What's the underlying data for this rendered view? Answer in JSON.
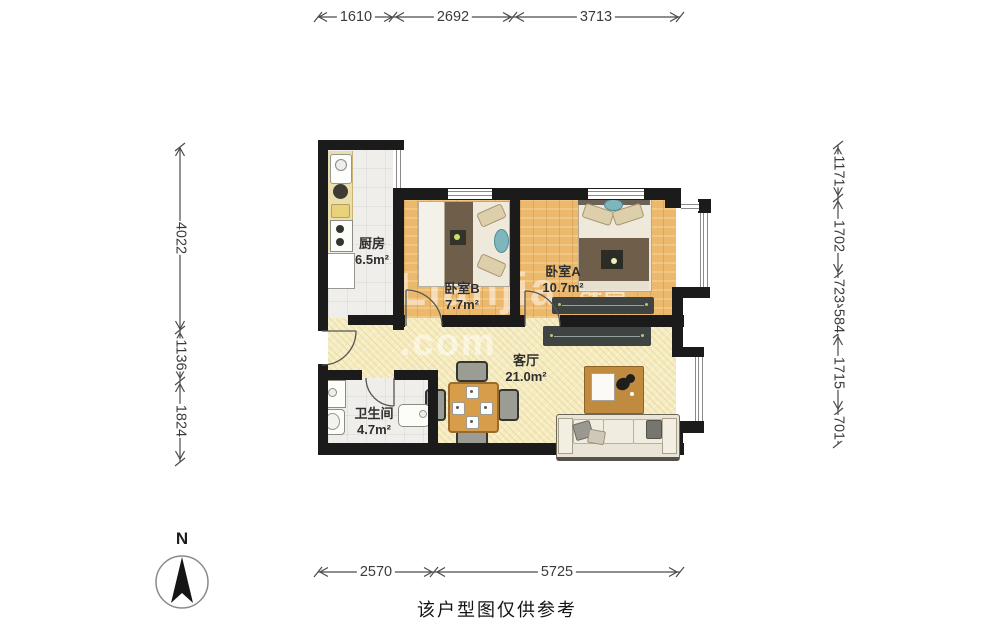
{
  "meta": {
    "caption": "该户型图仅供参考",
    "north_label": "N",
    "watermark_line1": "Lianjia",
    "watermark_line2": ".com",
    "watermark_cn": "链家"
  },
  "rooms": [
    {
      "id": "kitchen",
      "name": "厨房",
      "area": "6.5m²"
    },
    {
      "id": "bedroom_b",
      "name": "卧室B",
      "area": "7.7m²"
    },
    {
      "id": "bedroom_a",
      "name": "卧室A",
      "area": "10.7m²"
    },
    {
      "id": "living",
      "name": "客厅",
      "area": "21.0m²"
    },
    {
      "id": "bathroom",
      "name": "卫生间",
      "area": "4.7m²"
    }
  ],
  "dimensions_mm": {
    "top": [
      "1610",
      "2692",
      "3713"
    ],
    "bottom": [
      "2570",
      "5725"
    ],
    "left": [
      "4022",
      "1136",
      "1824"
    ],
    "right": [
      "1171",
      "1702",
      "723",
      "584",
      "1715",
      "701"
    ]
  },
  "colors": {
    "wall": "#1b1b1b",
    "wood_floor": "#ecb96c",
    "living_floor": "#f6ecc1",
    "tile_floor": "#f0eeea",
    "duvet_brown": "#6f5e49",
    "bench_dark": "#3f4443",
    "table_wood": "#d79d4b",
    "accent_teal": "#7fb6bd",
    "dim_text": "#3b3b3b"
  }
}
